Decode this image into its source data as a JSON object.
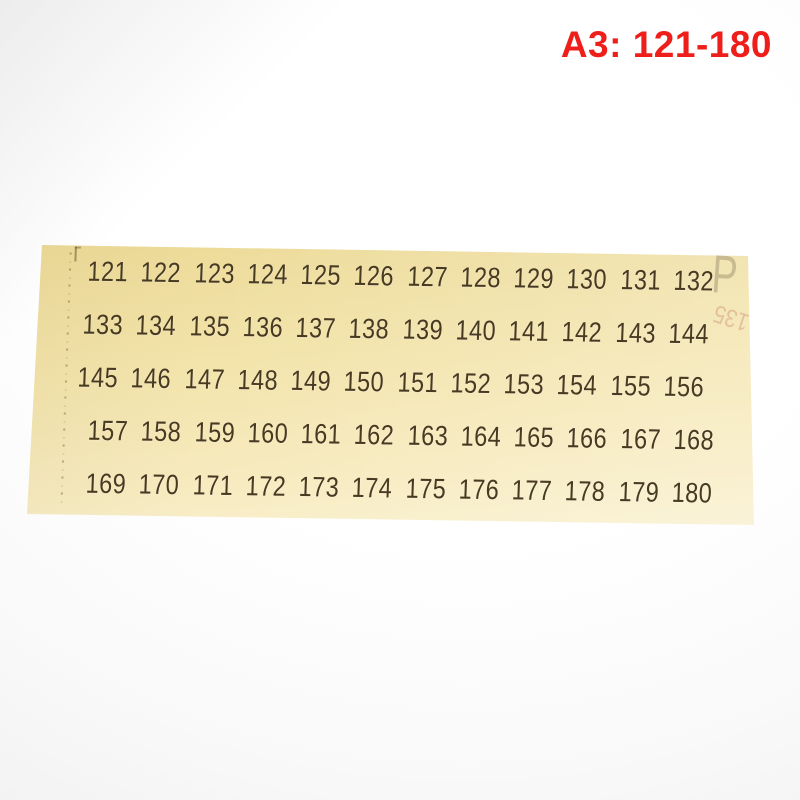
{
  "label": {
    "text": "A3: 121-180",
    "color": "#ee1f1b"
  },
  "sheet": {
    "paper_color_top": "#ecda97",
    "paper_color_bottom": "#f9f0cd",
    "number_color": "#483a20",
    "rows": [
      [
        "121",
        "122",
        "123",
        "124",
        "125",
        "126",
        "127",
        "128",
        "129",
        "130",
        "131",
        "132"
      ],
      [
        "133",
        "134",
        "135",
        "136",
        "137",
        "138",
        "139",
        "140",
        "141",
        "142",
        "143",
        "144"
      ],
      [
        "145",
        "146",
        "147",
        "148",
        "149",
        "150",
        "151",
        "152",
        "153",
        "154",
        "155",
        "156"
      ],
      [
        "157",
        "158",
        "159",
        "160",
        "161",
        "162",
        "163",
        "164",
        "165",
        "166",
        "167",
        "168"
      ],
      [
        "169",
        "170",
        "171",
        "172",
        "173",
        "174",
        "175",
        "176",
        "177",
        "178",
        "179",
        "180"
      ]
    ],
    "marks": {
      "corner_p": "P",
      "ghost_number": "135"
    }
  }
}
